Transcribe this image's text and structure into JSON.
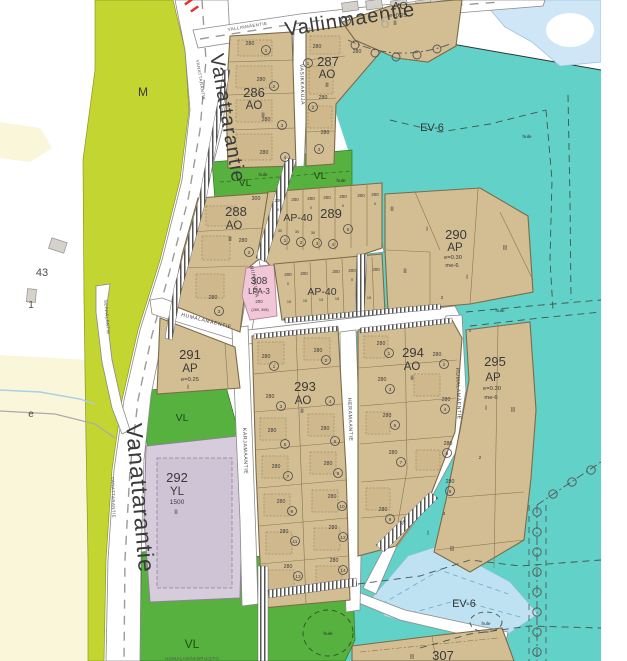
{
  "map": {
    "colors": {
      "residential_tan": "#d3bd92",
      "green_belt_teal": "#62d1c8",
      "park_green": "#56b13e",
      "agriculture_green": "#c3d531",
      "public_building_purple": "#d7ccdc",
      "parking_pink": "#f1c6d6",
      "water_blue": "#cfe6f6",
      "field_yellow": "#faf6da",
      "road_white": "#ffffff",
      "tick_red": "#e23333"
    },
    "zone_labels": {
      "m": "M",
      "ev6": "EV-6",
      "vl": "VL",
      "hule": "hule",
      "pp": "pp"
    },
    "districts": {
      "d286": {
        "num": "286",
        "code": "AO"
      },
      "d287": {
        "num": "287",
        "code": "AO"
      },
      "d288": {
        "num": "288",
        "code": "AO"
      },
      "d289": {
        "num": "289",
        "code": "AP-40"
      },
      "d290": {
        "num": "290",
        "code": "AP",
        "eff": "e=0.30",
        "me": "me-6"
      },
      "d291": {
        "num": "291",
        "code": "AP",
        "eff": "e=0.25"
      },
      "d292": {
        "num": "292",
        "code": "YL",
        "sqm": "1500"
      },
      "d293": {
        "num": "293",
        "code": "AO"
      },
      "d294": {
        "num": "294",
        "code": "AO"
      },
      "d295": {
        "num": "295",
        "code": "AP",
        "eff": "e=0.30",
        "me": "me-6"
      },
      "d296": {
        "num": "6",
        "code": "AO",
        "eff": "e=0.25"
      },
      "d307": {
        "num": "307"
      },
      "d308": {
        "num": "308",
        "code": "LPA-3",
        "plot": "200",
        "ref": "(289, 308)"
      },
      "ap40": {
        "code": "AP-40"
      }
    },
    "streets": {
      "vanattarantie": "Vanattarantie",
      "vanattarantie_small": "VANATTARANTIE",
      "vallinmaentie": "Vallinmaentie",
      "vallinmaentie_small": "VALLINMÄENTIE",
      "vasikkakuja": "VASIKKAKUJA",
      "niipokuja": "NIIPOKUJA",
      "humalamaentie": "HUMALAMÄENTIE",
      "karjamaantie": "KARJAMAANTIE",
      "heramaantie": "HERAMAANTIE",
      "seppalantie": "SEPPÄLÄNTIE"
    },
    "plot_sizes": {
      "s280": "280",
      "s300": "300",
      "s200": "200",
      "s30": "30",
      "s15": "15"
    },
    "floors": {
      "i": "I",
      "ii": "II"
    },
    "circ": [
      "1",
      "2",
      "3",
      "4",
      "5",
      "6",
      "7",
      "8",
      "9",
      "10",
      "11",
      "12",
      "13",
      "14"
    ],
    "parcels": {
      "p43": "43",
      "p1": "1",
      "road_e": "e"
    },
    "park_name": "HUMALAMÄENPUISTO"
  }
}
